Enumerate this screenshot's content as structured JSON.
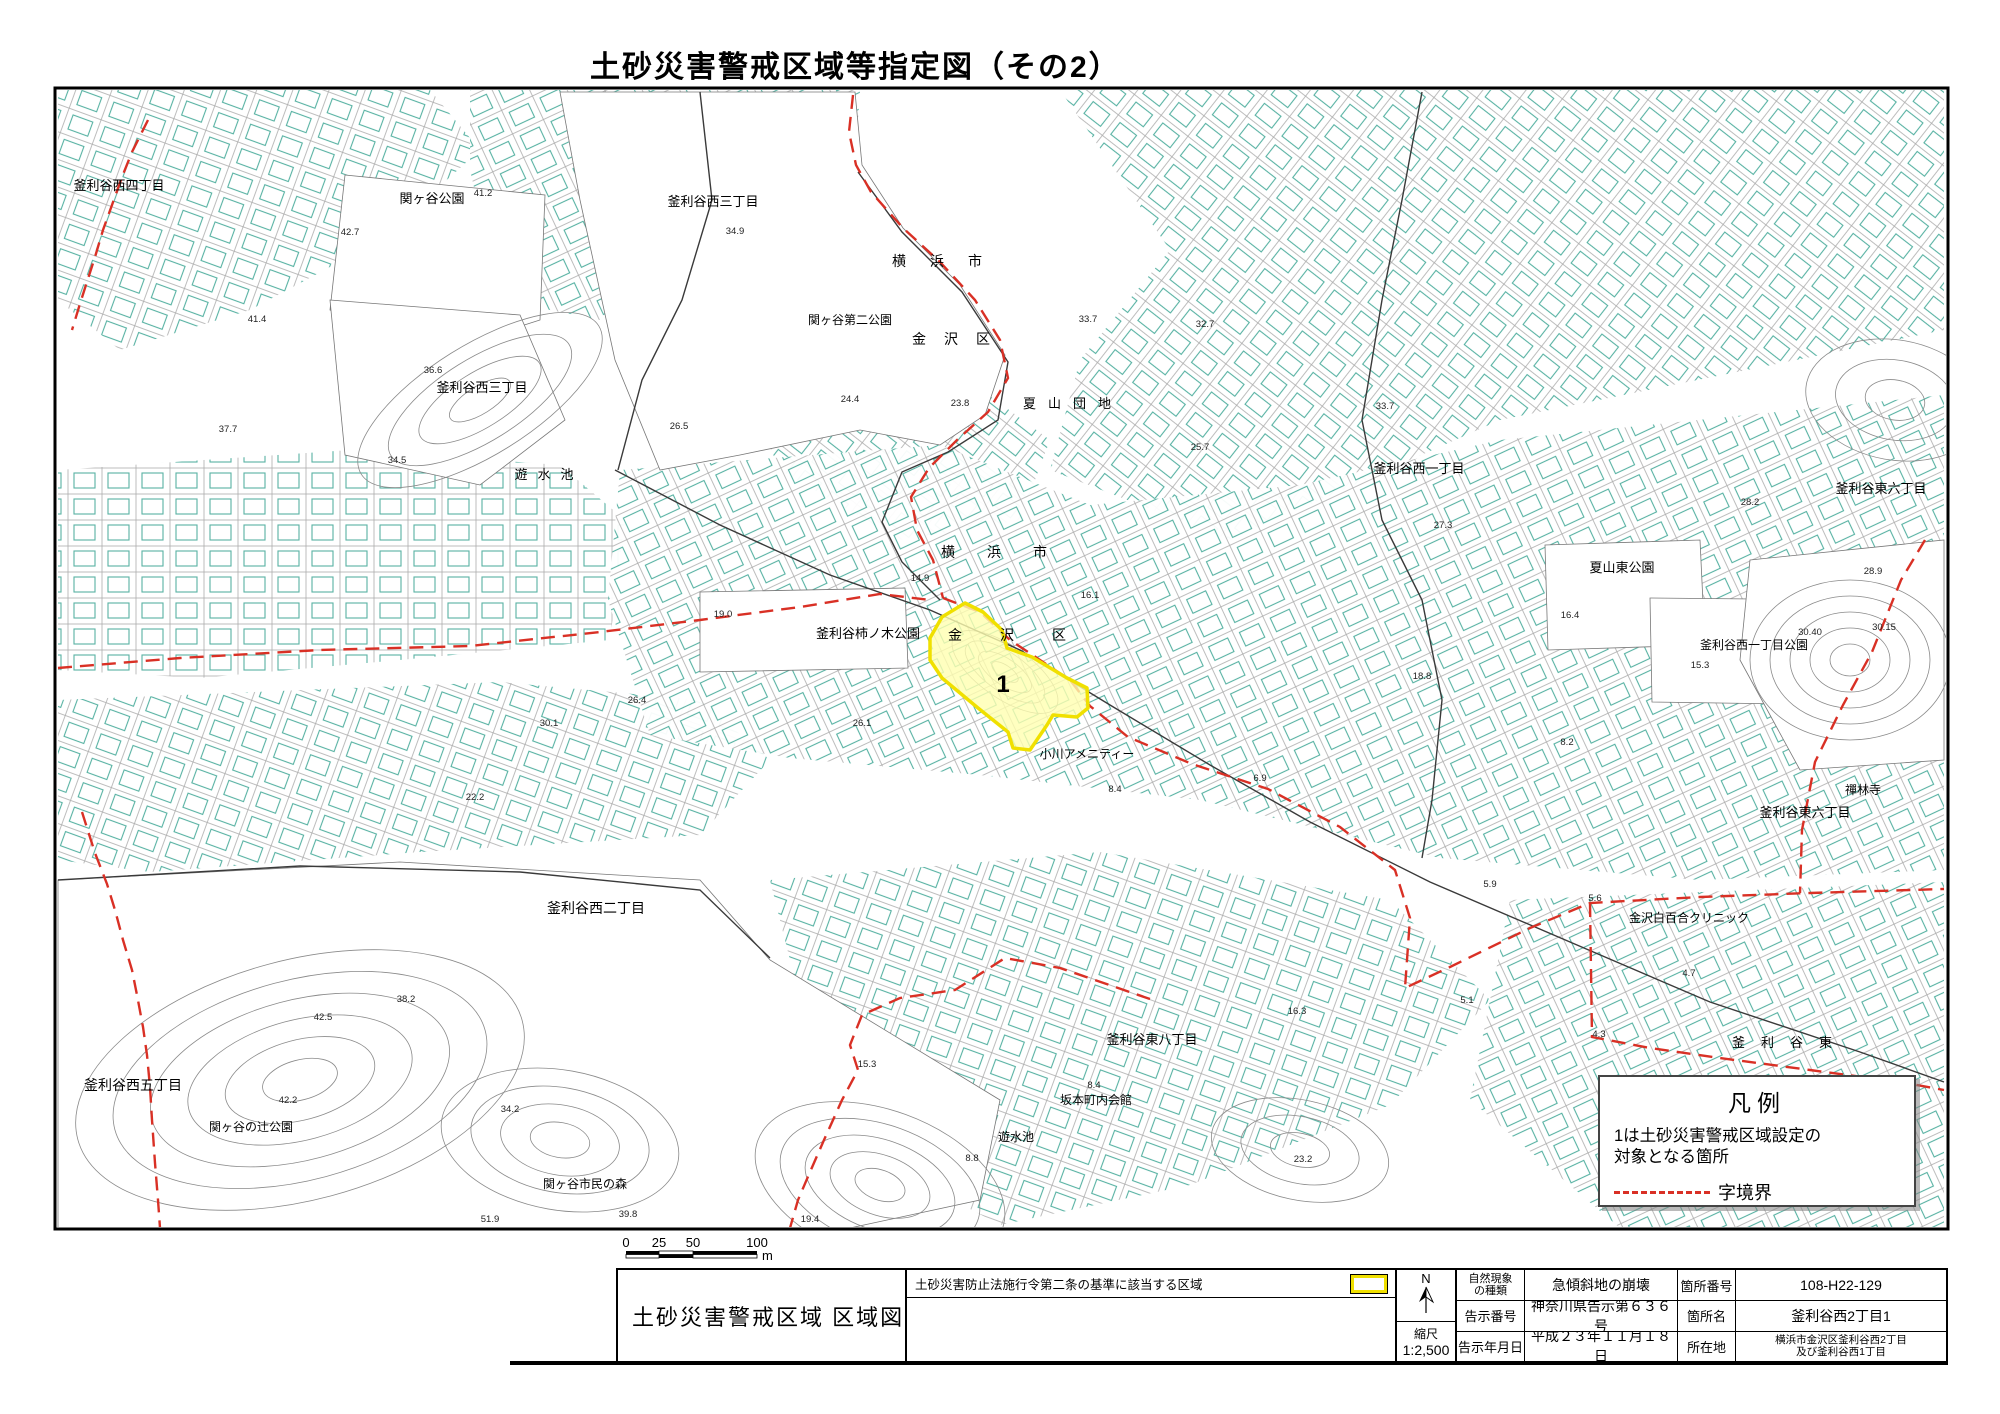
{
  "title": "土砂災害警戒区域等指定図（その2）",
  "colors": {
    "hazard_fill": "#ffffb0",
    "hazard_border": "#f0e000",
    "boundary": "#d93025",
    "building": "#4fae9e",
    "parcel_line": "#a8a8a8"
  },
  "legend": {
    "title": "凡例",
    "desc_line1": "1は土砂災害警戒区域設定の",
    "desc_line2": "対象となる箇所",
    "boundary_label": "字境界"
  },
  "scale_bar": {
    "labels": [
      "0",
      "25",
      "50",
      "100"
    ],
    "unit": "m"
  },
  "title_block": {
    "map_title": "土砂災害警戒区域  区域図",
    "criteria_label": "土砂災害防止法施行令第二条の基準に該当する区域",
    "north_label": "N",
    "scale_label": "縮尺",
    "scale_value": "1:2,500",
    "phenomenon_label_1": "自然現象",
    "phenomenon_label_2": "の種類",
    "phenomenon_value": "急傾斜地の崩壊",
    "notice_no_label": "告示番号",
    "notice_no_value": "神奈川県告示第６３６号",
    "notice_date_label": "告示年月日",
    "notice_date_value": "平成２３年１１月１８日",
    "site_no_label": "箇所番号",
    "site_no_value": "108-H22-129",
    "site_name_label": "箇所名",
    "site_name_value": "釜利谷西2丁目1",
    "location_label": "所在地",
    "location_value_1": "横浜市金沢区釜利谷西2丁目",
    "location_value_2": "及び釜利谷西1丁目"
  },
  "map": {
    "hazard_area": {
      "id_label": "1",
      "label_pos": [
        1003,
        692
      ],
      "points": [
        [
          942,
          617
        ],
        [
          965,
          603
        ],
        [
          983,
          612
        ],
        [
          1002,
          630
        ],
        [
          1007,
          648
        ],
        [
          1032,
          657
        ],
        [
          1067,
          678
        ],
        [
          1087,
          688
        ],
        [
          1088,
          708
        ],
        [
          1077,
          717
        ],
        [
          1053,
          715
        ],
        [
          1047,
          725
        ],
        [
          1030,
          750
        ],
        [
          1013,
          748
        ],
        [
          1008,
          732
        ],
        [
          978,
          708
        ],
        [
          960,
          693
        ],
        [
          942,
          678
        ],
        [
          930,
          660
        ],
        [
          930,
          638
        ]
      ]
    },
    "labels": [
      {
        "t": "釜利谷西四丁目",
        "x": 119,
        "y": 190,
        "s": 13
      },
      {
        "t": "関ヶ谷公園",
        "x": 432,
        "y": 203,
        "s": 13
      },
      {
        "t": "釜利谷西三丁目",
        "x": 713,
        "y": 206,
        "s": 13
      },
      {
        "t": "横浜市",
        "x": 949,
        "y": 266,
        "s": 14,
        "ls": 24
      },
      {
        "t": "関ヶ谷第二公園",
        "x": 850,
        "y": 324,
        "s": 12
      },
      {
        "t": "金沢区",
        "x": 960,
        "y": 344,
        "s": 14,
        "ls": 18
      },
      {
        "t": "夏山団地",
        "x": 1073,
        "y": 408,
        "s": 13,
        "ls": 12
      },
      {
        "t": "釜利谷西三丁目",
        "x": 482,
        "y": 392,
        "s": 13
      },
      {
        "t": "遊水池",
        "x": 549,
        "y": 479,
        "s": 13,
        "ls": 10
      },
      {
        "t": "釜利谷西一丁目",
        "x": 1419,
        "y": 473,
        "s": 13
      },
      {
        "t": "釜利谷東六丁目",
        "x": 1881,
        "y": 493,
        "s": 13
      },
      {
        "t": "夏山東公園",
        "x": 1622,
        "y": 572,
        "s": 13
      },
      {
        "t": "横浜市",
        "x": 1010,
        "y": 557,
        "s": 14,
        "ls": 32
      },
      {
        "t": "釜利谷柿ノ木公園",
        "x": 868,
        "y": 638,
        "s": 13
      },
      {
        "t": "金沢区",
        "x": 1026,
        "y": 640,
        "s": 14,
        "ls": 38
      },
      {
        "t": "釜利谷西一丁目公園",
        "x": 1754,
        "y": 649,
        "s": 12
      },
      {
        "t": "禪林寺",
        "x": 1863,
        "y": 794,
        "s": 12
      },
      {
        "t": "釜利谷東六丁目",
        "x": 1805,
        "y": 817,
        "s": 13
      },
      {
        "t": "小川アメニティー",
        "x": 1087,
        "y": 758,
        "s": 12
      },
      {
        "t": "金沢白百合クリニック",
        "x": 1689,
        "y": 922,
        "s": 12
      },
      {
        "t": "釜利谷西二丁目",
        "x": 596,
        "y": 913,
        "s": 14
      },
      {
        "t": "釜利谷東",
        "x": 1790,
        "y": 1047,
        "s": 13,
        "ls": 16
      },
      {
        "t": "釜利谷西五丁目",
        "x": 133,
        "y": 1090,
        "s": 14
      },
      {
        "t": "関ヶ谷の辻公園",
        "x": 251,
        "y": 1131,
        "s": 12
      },
      {
        "t": "関ヶ谷市民の森",
        "x": 585,
        "y": 1188,
        "s": 12
      },
      {
        "t": "釜利谷東八丁目",
        "x": 1152,
        "y": 1044,
        "s": 13
      },
      {
        "t": "坂本町内会館",
        "x": 1096,
        "y": 1104,
        "s": 12
      },
      {
        "t": "遊水池",
        "x": 1016,
        "y": 1141,
        "s": 12
      }
    ],
    "spot_heights": [
      {
        "t": "42.7",
        "x": 350,
        "y": 235
      },
      {
        "t": "41.2",
        "x": 483,
        "y": 196
      },
      {
        "t": "41.4",
        "x": 257,
        "y": 322
      },
      {
        "t": "37.7",
        "x": 228,
        "y": 432
      },
      {
        "t": "34.9",
        "x": 735,
        "y": 234
      },
      {
        "t": "24.4",
        "x": 850,
        "y": 402
      },
      {
        "t": "23.8",
        "x": 960,
        "y": 406
      },
      {
        "t": "26.5",
        "x": 679,
        "y": 429
      },
      {
        "t": "36.6",
        "x": 433,
        "y": 373
      },
      {
        "t": "34.5",
        "x": 397,
        "y": 463
      },
      {
        "t": "14.9",
        "x": 920,
        "y": 581
      },
      {
        "t": "19.0",
        "x": 723,
        "y": 617
      },
      {
        "t": "16.1",
        "x": 1090,
        "y": 598
      },
      {
        "t": "26.4",
        "x": 637,
        "y": 703
      },
      {
        "t": "30.1",
        "x": 549,
        "y": 726
      },
      {
        "t": "26.1",
        "x": 862,
        "y": 726
      },
      {
        "t": "22.2",
        "x": 475,
        "y": 800
      },
      {
        "t": "33.7",
        "x": 1088,
        "y": 322
      },
      {
        "t": "32.7",
        "x": 1205,
        "y": 327
      },
      {
        "t": "33.7",
        "x": 1385,
        "y": 409
      },
      {
        "t": "25.7",
        "x": 1200,
        "y": 450
      },
      {
        "t": "27.3",
        "x": 1443,
        "y": 528
      },
      {
        "t": "16.4",
        "x": 1570,
        "y": 618
      },
      {
        "t": "28.2",
        "x": 1750,
        "y": 505
      },
      {
        "t": "28.9",
        "x": 1873,
        "y": 574
      },
      {
        "t": "30.40",
        "x": 1810,
        "y": 635
      },
      {
        "t": "30.15",
        "x": 1884,
        "y": 630
      },
      {
        "t": "15.3",
        "x": 1700,
        "y": 668
      },
      {
        "t": "18.8",
        "x": 1422,
        "y": 679
      },
      {
        "t": "8.2",
        "x": 1567,
        "y": 745
      },
      {
        "t": "8.4",
        "x": 1115,
        "y": 792
      },
      {
        "t": "6.9",
        "x": 1260,
        "y": 781
      },
      {
        "t": "5.9",
        "x": 1490,
        "y": 887
      },
      {
        "t": "5.6",
        "x": 1595,
        "y": 901
      },
      {
        "t": "4.7",
        "x": 1689,
        "y": 976
      },
      {
        "t": "4.3",
        "x": 1599,
        "y": 1037
      },
      {
        "t": "5.1",
        "x": 1467,
        "y": 1003
      },
      {
        "t": "16.3",
        "x": 1297,
        "y": 1014
      },
      {
        "t": "15.3",
        "x": 867,
        "y": 1067
      },
      {
        "t": "8.4",
        "x": 1094,
        "y": 1088
      },
      {
        "t": "8.8",
        "x": 972,
        "y": 1161
      },
      {
        "t": "23.2",
        "x": 1303,
        "y": 1162
      },
      {
        "t": "19.4",
        "x": 810,
        "y": 1222
      },
      {
        "t": "51.9",
        "x": 490,
        "y": 1222
      },
      {
        "t": "39.8",
        "x": 628,
        "y": 1217
      },
      {
        "t": "34.2",
        "x": 510,
        "y": 1112
      },
      {
        "t": "38.2",
        "x": 406,
        "y": 1002
      },
      {
        "t": "42.5",
        "x": 323,
        "y": 1020
      },
      {
        "t": "42.2",
        "x": 288,
        "y": 1103
      }
    ],
    "boundaries": [
      [
        [
          853,
          95
        ],
        [
          849,
          132
        ],
        [
          856,
          165
        ],
        [
          871,
          192
        ],
        [
          903,
          228
        ],
        [
          940,
          262
        ],
        [
          975,
          300
        ],
        [
          1000,
          340
        ],
        [
          1008,
          378
        ],
        [
          988,
          412
        ],
        [
          957,
          440
        ],
        [
          929,
          468
        ],
        [
          911,
          497
        ],
        [
          917,
          530
        ],
        [
          933,
          560
        ],
        [
          943,
          598
        ]
      ],
      [
        [
          943,
          598
        ],
        [
          980,
          612
        ],
        [
          1010,
          640
        ],
        [
          1040,
          660
        ],
        [
          1070,
          680
        ],
        [
          1090,
          706
        ],
        [
          1128,
          737
        ],
        [
          1192,
          764
        ],
        [
          1268,
          789
        ],
        [
          1340,
          827
        ],
        [
          1395,
          870
        ],
        [
          1410,
          918
        ],
        [
          1405,
          988
        ],
        [
          1450,
          967
        ],
        [
          1530,
          928
        ],
        [
          1590,
          903
        ],
        [
          1700,
          897
        ],
        [
          1810,
          893
        ],
        [
          1944,
          889
        ]
      ],
      [
        [
          1590,
          903
        ],
        [
          1591,
          970
        ],
        [
          1592,
          1037
        ],
        [
          1650,
          1048
        ],
        [
          1720,
          1058
        ],
        [
          1810,
          1070
        ],
        [
          1900,
          1082
        ],
        [
          1944,
          1090
        ]
      ],
      [
        [
          1925,
          540
        ],
        [
          1901,
          580
        ],
        [
          1872,
          652
        ],
        [
          1843,
          705
        ],
        [
          1815,
          762
        ],
        [
          1802,
          830
        ],
        [
          1800,
          893
        ]
      ],
      [
        [
          1150,
          999
        ],
        [
          1060,
          968
        ],
        [
          1005,
          958
        ],
        [
          955,
          990
        ],
        [
          900,
          998
        ],
        [
          862,
          1015
        ],
        [
          850,
          1045
        ],
        [
          858,
          1070
        ],
        [
          842,
          1100
        ],
        [
          824,
          1140
        ],
        [
          810,
          1172
        ],
        [
          798,
          1200
        ],
        [
          790,
          1228
        ]
      ],
      [
        [
          82,
          812
        ],
        [
          95,
          853
        ],
        [
          107,
          884
        ],
        [
          115,
          910
        ],
        [
          123,
          940
        ],
        [
          132,
          970
        ],
        [
          137,
          995
        ],
        [
          143,
          1027
        ],
        [
          147,
          1055
        ],
        [
          150,
          1087
        ],
        [
          152,
          1120
        ],
        [
          155,
          1163
        ],
        [
          158,
          1200
        ],
        [
          160,
          1228
        ]
      ],
      [
        [
          148,
          120
        ],
        [
          132,
          152
        ],
        [
          122,
          177
        ],
        [
          112,
          205
        ],
        [
          103,
          230
        ],
        [
          95,
          257
        ],
        [
          85,
          288
        ],
        [
          79,
          307
        ],
        [
          72,
          330
        ]
      ],
      [
        [
          58,
          668
        ],
        [
          180,
          658
        ],
        [
          320,
          650
        ],
        [
          470,
          646
        ],
        [
          600,
          632
        ],
        [
          700,
          620
        ],
        [
          800,
          607
        ],
        [
          880,
          594
        ],
        [
          930,
          600
        ]
      ]
    ]
  }
}
